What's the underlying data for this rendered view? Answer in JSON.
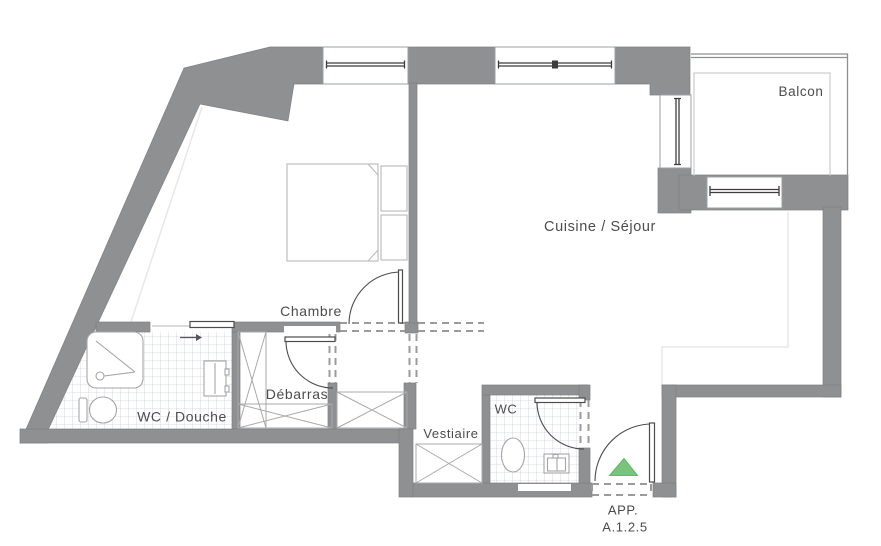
{
  "plan": {
    "type": "apartment-floor-plan",
    "rooms": {
      "balcon": {
        "label": "Balcon"
      },
      "cuisine_sejour": {
        "label": "Cuisine / Séjour"
      },
      "chambre": {
        "label": "Chambre"
      },
      "wc_douche": {
        "label": "WC / Douche"
      },
      "debarras": {
        "label": "Débarras"
      },
      "vestiaire": {
        "label": "Vestiaire"
      },
      "wc": {
        "label": "WC"
      }
    },
    "apartment": {
      "line1": "APP.",
      "line2": "A.1.2.5"
    },
    "colors": {
      "wall": "#8e9092",
      "entrance_marker": "#79c47c",
      "entrance_marker_edge": "#69b56c",
      "label_text": "#4c4c4e"
    },
    "icons": {
      "entrance_marker": "green-triangle-up",
      "sliding_door_arrow": "right-arrow"
    }
  }
}
